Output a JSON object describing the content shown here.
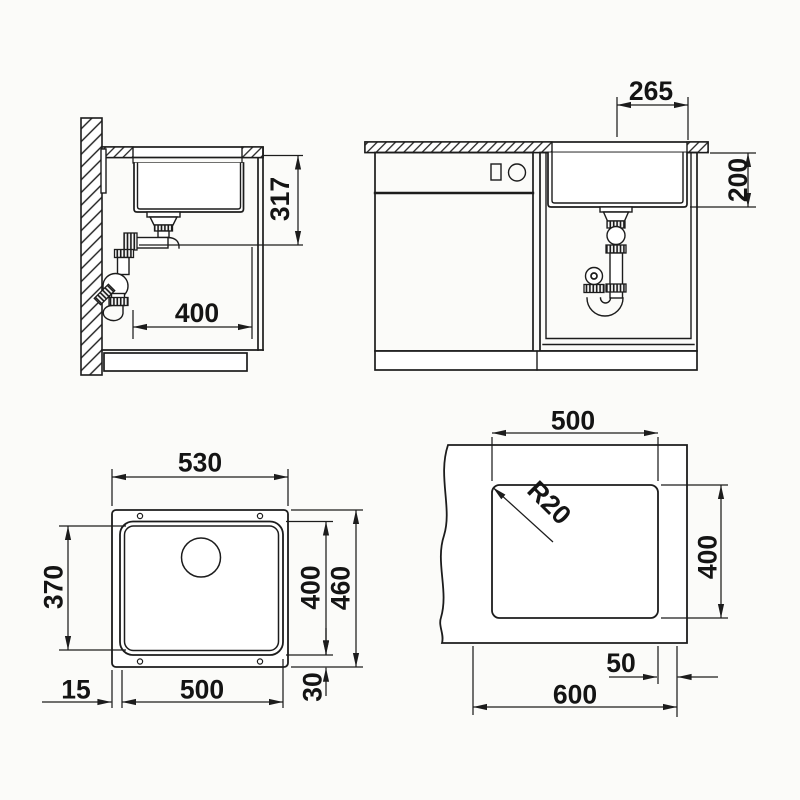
{
  "drawing": {
    "background": "#fbfbf9",
    "ink": "#1c1c1c",
    "views": {
      "side_section": {
        "height": "317",
        "depth": "400"
      },
      "front": {
        "drain_offset": "265",
        "bowl_depth": "200"
      },
      "plan": {
        "outer_width": "530",
        "inner_depth": "370",
        "bowl_outer_depth": "400",
        "outer_depth": "460",
        "edge_gap": "15",
        "bowl_width": "500",
        "rim_gap": "30"
      },
      "cutout": {
        "width": "500",
        "corner_radius": "R20",
        "depth": "400",
        "edge_distance": "50",
        "cabinet_width": "600"
      }
    }
  }
}
